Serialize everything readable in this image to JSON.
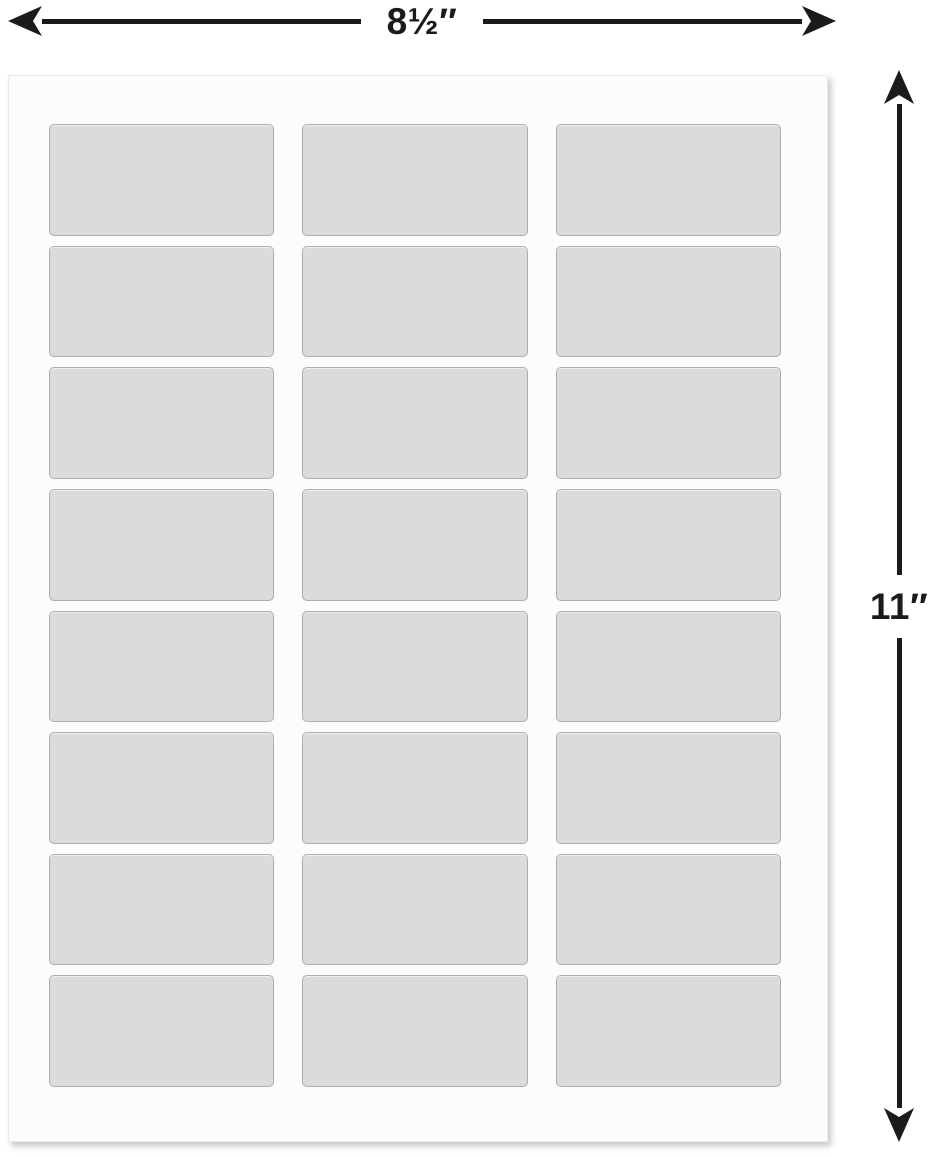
{
  "diagram": {
    "width_dimension": {
      "label": "8½″"
    },
    "height_dimension": {
      "label": "11″"
    }
  },
  "sheet": {
    "rows": 8,
    "columns": 3,
    "label_count": 24
  },
  "colors": {
    "dimension_lines": "#1b1b1b",
    "sheet_background": "#fcfcfd",
    "label_fill": "#d9dbdc",
    "label_border": "#abafb2"
  }
}
